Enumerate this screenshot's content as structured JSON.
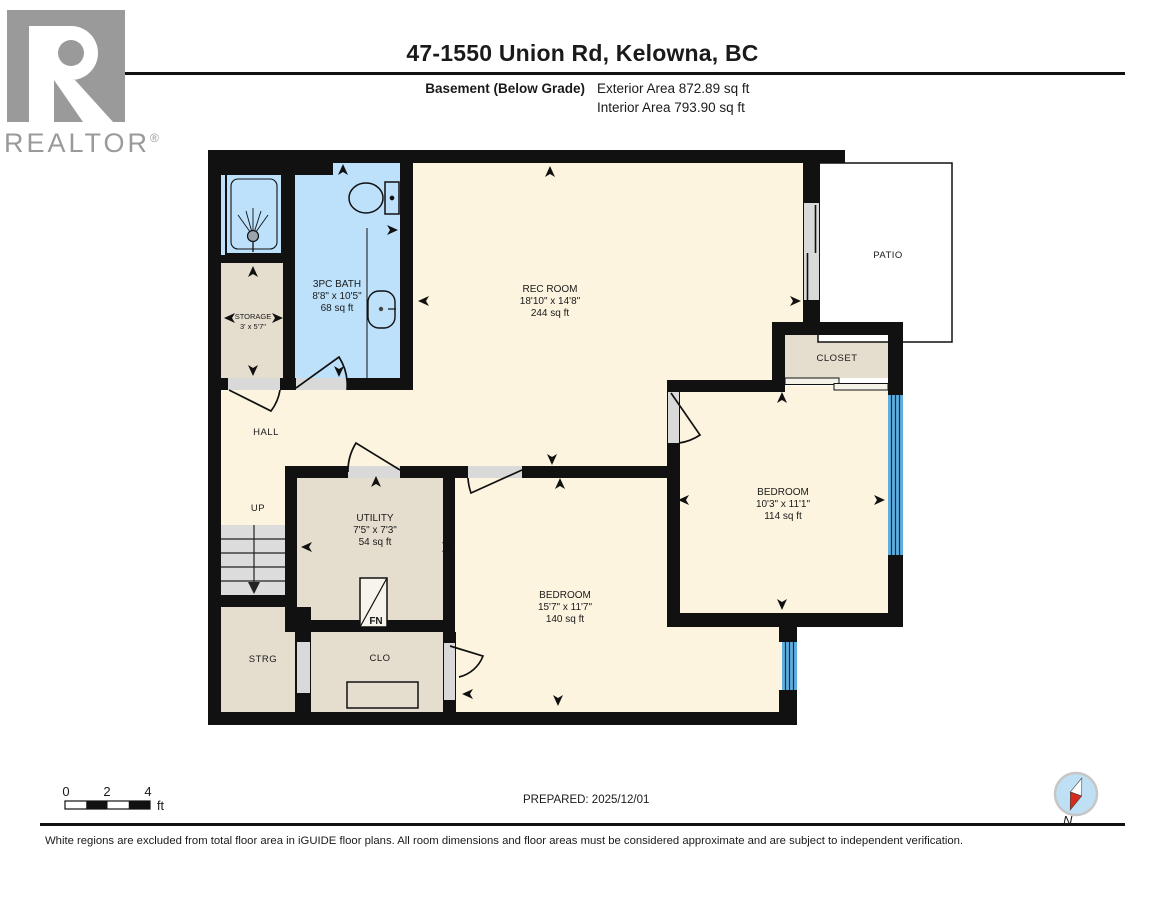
{
  "header": {
    "title": "47-1550 Union Rd, Kelowna, BC",
    "floor_label": "Basement (Below Grade)",
    "exterior_area": "Exterior Area 872.89 sq ft",
    "interior_area": "Interior Area 793.90 sq ft",
    "brand": "REALTOR",
    "brand_reg": "®"
  },
  "rooms": {
    "bath": {
      "name": "3PC BATH",
      "dims": "8'8\" x 10'5\"",
      "area": "68 sq ft"
    },
    "storage": {
      "name": "STORAGE",
      "dims": "3' x 5'7\""
    },
    "rec": {
      "name": "REC ROOM",
      "dims": "18'10\" x 14'8\"",
      "area": "244 sq ft"
    },
    "patio": {
      "name": "PATIO"
    },
    "closet": {
      "name": "CLOSET"
    },
    "hall": {
      "name": "HALL"
    },
    "up": {
      "name": "UP"
    },
    "utility": {
      "name": "UTILITY",
      "dims": "7'5\" x 7'3\"",
      "area": "54 sq ft"
    },
    "bedroom1": {
      "name": "BEDROOM",
      "dims": "15'7\" x 11'7\"",
      "area": "140 sq ft"
    },
    "bedroom2": {
      "name": "BEDROOM",
      "dims": "10'3\" x 11'1\"",
      "area": "114 sq ft"
    },
    "strg": {
      "name": "STRG"
    },
    "clo": {
      "name": "CLO"
    },
    "furnace_label": "FN"
  },
  "icons": [
    "toilet-icon",
    "sink-icon",
    "shower-icon",
    "furnace-icon",
    "compass-icon",
    "stairs-icon"
  ],
  "footer": {
    "scale": {
      "tick0": "0",
      "tick2": "2",
      "tick4": "4",
      "unit": "ft"
    },
    "prepared": "PREPARED: 2025/12/01",
    "compass_label": "N",
    "disclaimer": "White regions are excluded from total floor area in iGUIDE floor plans. All room dimensions and floor areas must be considered approximate and are subject to independent verification."
  },
  "colors": {
    "floor_cream": "#FCF4DF",
    "bath_blue": "#BDE1FB",
    "room_beige": "#E5DECF",
    "window_blue": "#5FAEE0",
    "door_gap_gray": "#D9D9D9",
    "wall_black": "#111111",
    "brand_gray": "#9A9A9A",
    "compass_red": "#D42B1E"
  }
}
